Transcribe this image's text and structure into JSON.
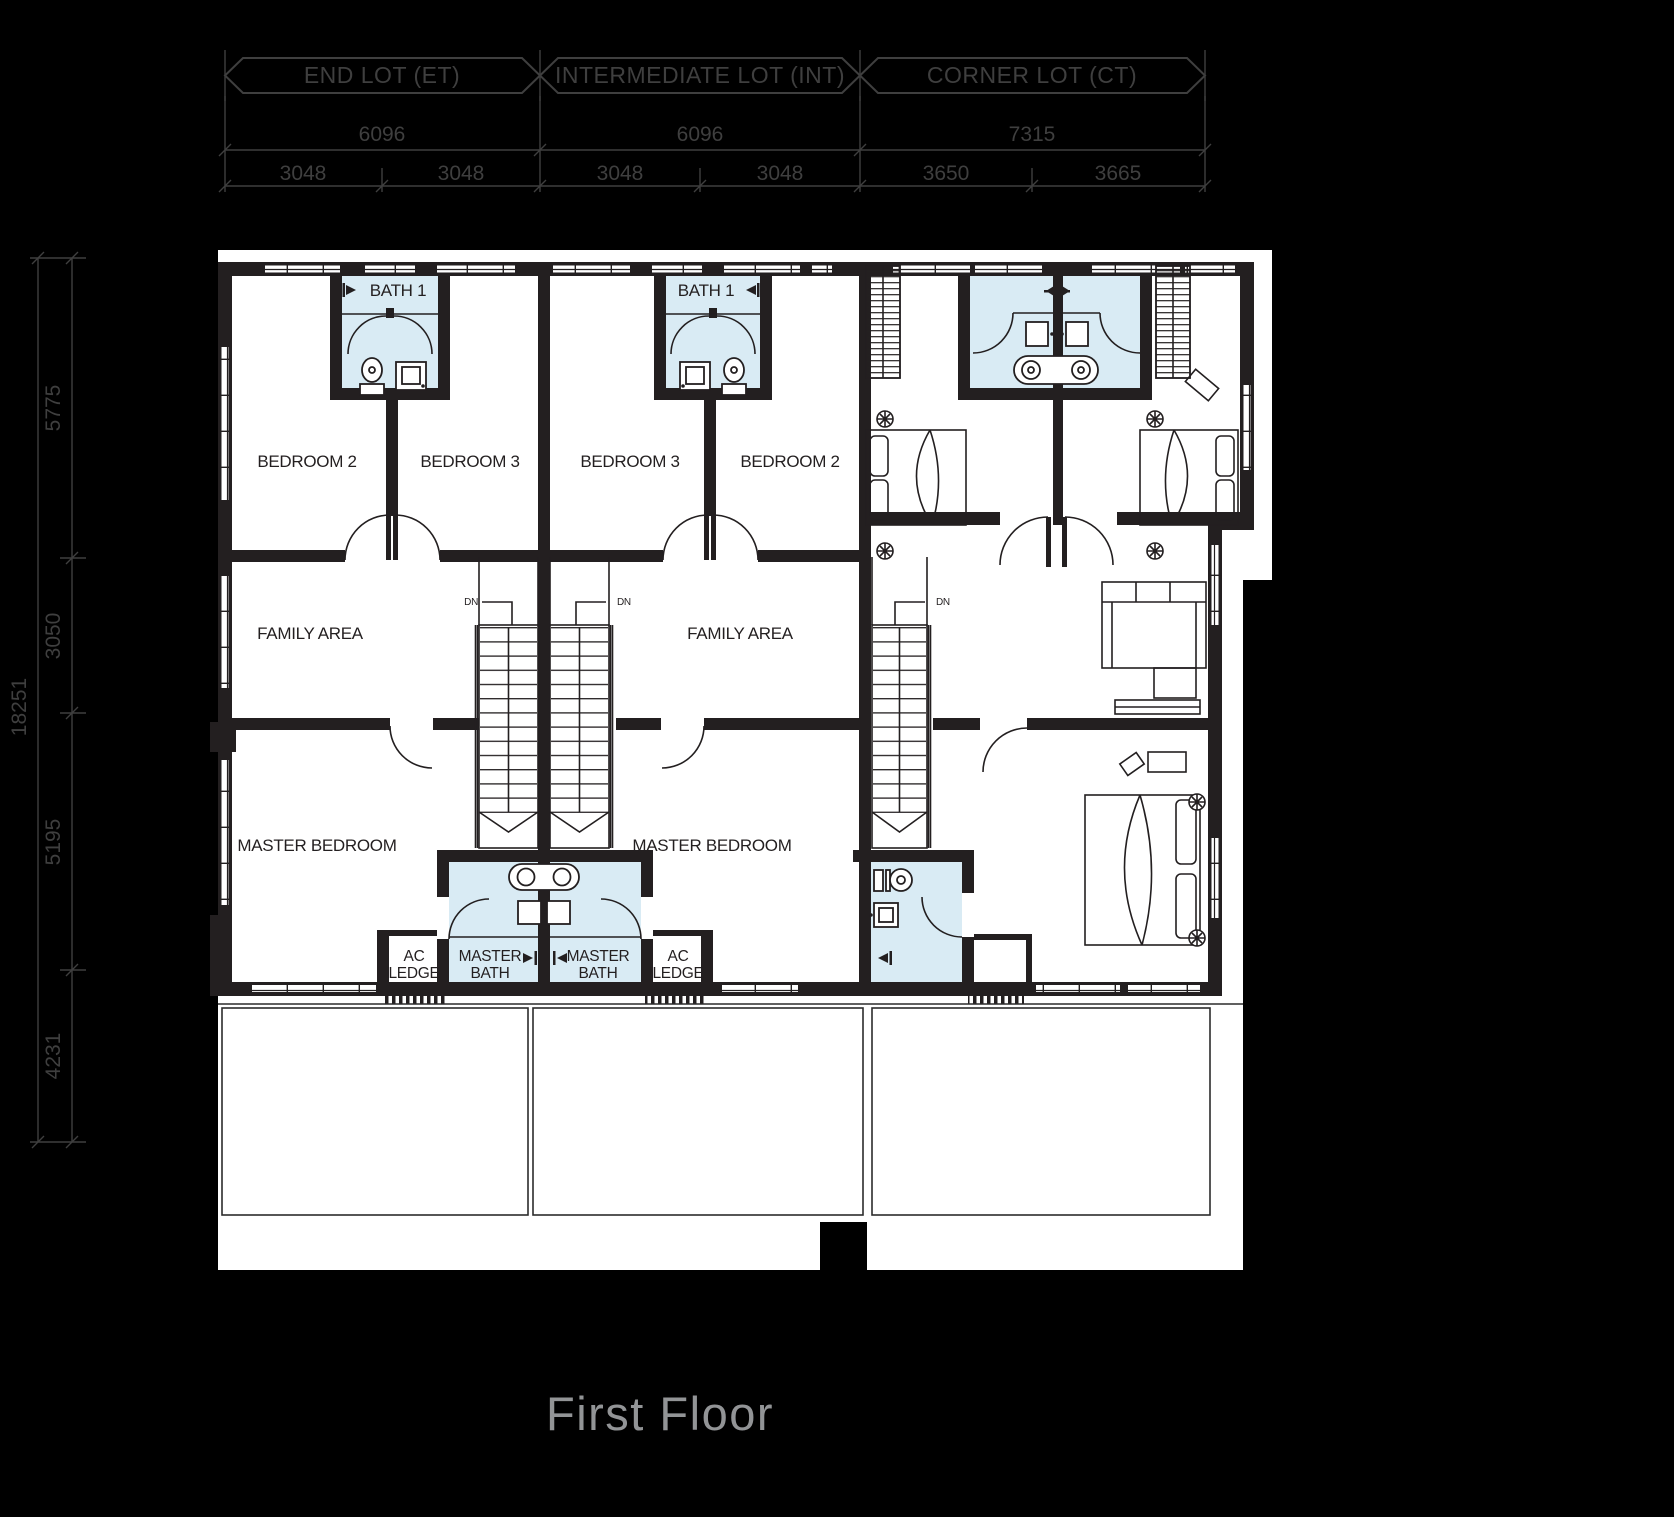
{
  "page": {
    "title": "First Floor"
  },
  "banners": [
    {
      "label": "END LOT (ET)"
    },
    {
      "label": "INTERMEDIATE LOT (INT)"
    },
    {
      "label": "CORNER LOT (CT)"
    }
  ],
  "dims": {
    "top_total": [
      "6096",
      "6096",
      "7315"
    ],
    "top_sub": [
      "3048",
      "3048",
      "3048",
      "3048",
      "3650",
      "3665"
    ],
    "left_total": "18251",
    "left_sub": [
      "5775",
      "3050",
      "5195",
      "4231"
    ]
  },
  "labels": {
    "bath1": "BATH 1",
    "bedroom2": "BEDROOM 2",
    "bedroom3": "BEDROOM 3",
    "family_area": "FAMILY AREA",
    "master_bedroom": "MASTER BEDROOM",
    "master_bath_line1": "MASTER",
    "master_bath_line2": "BATH",
    "ac_ledge_line1": "AC",
    "ac_ledge_line2": "LEDGE",
    "down": "DN"
  },
  "colors": {
    "background": "#000000",
    "paper": "#ffffff",
    "bath_fill": "#d9ebf4",
    "plan_line": "#231f20",
    "annotation": "#3f3f3f",
    "title": "#929496"
  }
}
